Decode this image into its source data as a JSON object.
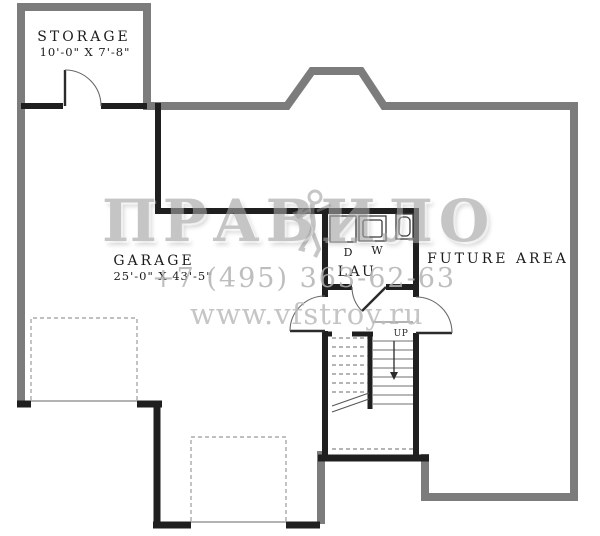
{
  "plan": {
    "kind": "basement-floor-plan",
    "rooms": {
      "storage": {
        "name": "STORAGE",
        "dims": "10'-0\" X 7'-8\""
      },
      "garage": {
        "name": "GARAGE",
        "dims": "25'-0\" X 43'-5\""
      },
      "laundry": {
        "name": "LAU"
      },
      "future_area": {
        "name": "FUTURE AREA"
      }
    },
    "fixtures": {
      "dryer": "D",
      "washer": "W"
    },
    "stairs": {
      "direction_label": "UP"
    }
  },
  "watermark": {
    "brand": "ПРАВИЛО",
    "phone": "+7 (495) 363-62-63",
    "site": "www.vfstroy.ru"
  },
  "colors": {
    "exterior_wall": "#7c7c7c",
    "interior_wall": "#1f1f1f",
    "watermark_gray": "#a2a2a2",
    "background": "#ffffff"
  }
}
